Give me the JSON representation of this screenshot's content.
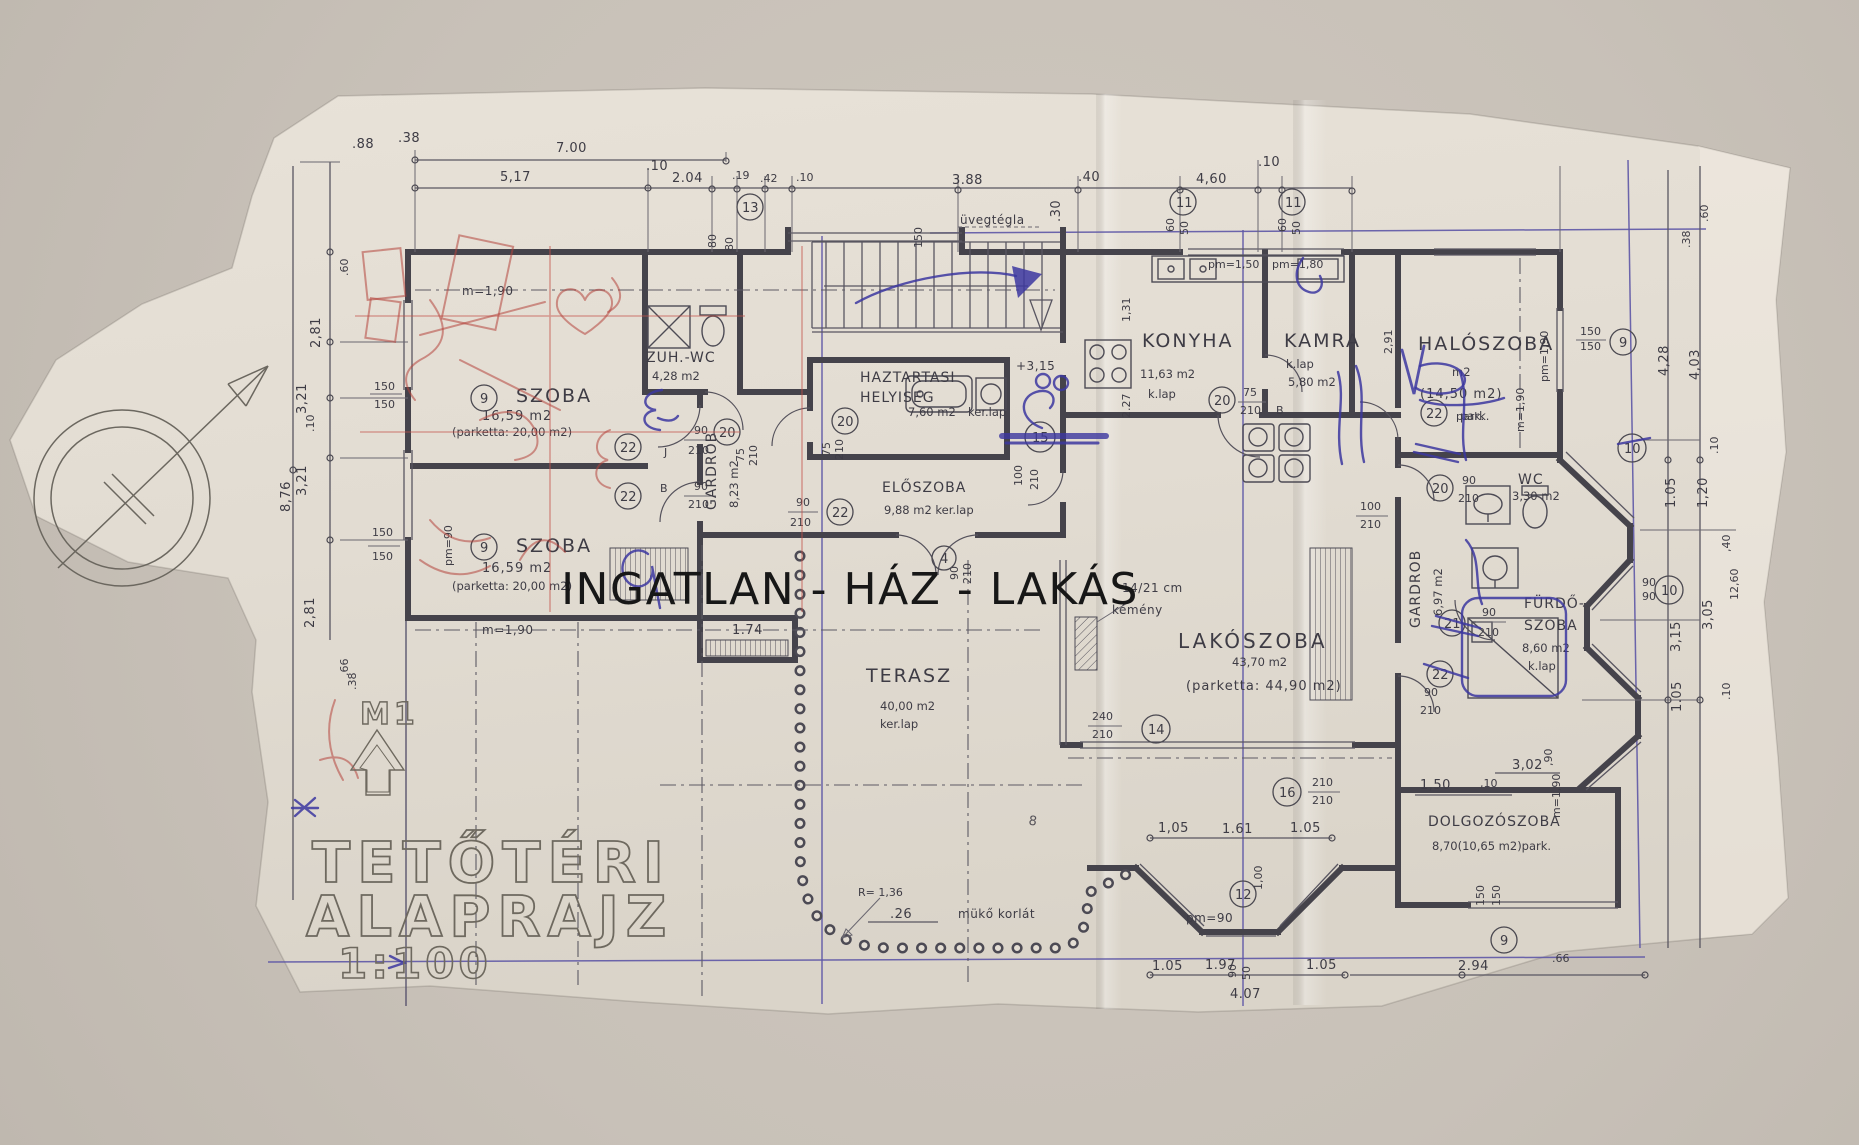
{
  "watermark": "INGATLAN - HÁZ - LAKÁS",
  "title": {
    "line1": "TETŐTÉRI",
    "line2": "ALAPRAJZ",
    "scale": "1:100",
    "section_marker": "M1"
  },
  "rooms": {
    "szoba1": {
      "name": "SZOBA",
      "area": "16,59 m2",
      "floor": "(parketta: 20,00 m2)"
    },
    "szoba2": {
      "name": "SZOBA",
      "area": "16,59 m2",
      "floor": "(parketta: 20,00 m2)"
    },
    "zuh_wc": {
      "name": "ZUH.-WC",
      "area": "4,28 m2"
    },
    "haztartasi": {
      "name_line1": "HAZTARTASI",
      "name_line2": "HELYISEG",
      "area": "7,60 m2",
      "floor": "ker.lap"
    },
    "eloszoba": {
      "name": "ELŐSZOBA",
      "area": "9,88 m2 ker.lap"
    },
    "konyha": {
      "name": "KONYHA",
      "area": "11,63 m2",
      "floor": "k.lap"
    },
    "kamra": {
      "name": "KAMRA",
      "area": "5,80 m2",
      "floor": "k.lap"
    },
    "haloszoba": {
      "name": "HALÓSZOBA",
      "area": "m2",
      "area2": "(14,50 m2)",
      "floor": "park."
    },
    "wc": {
      "name": "WC",
      "area": "3,30 m2"
    },
    "furdoszoba": {
      "name_line1": "FÜRDŐ-",
      "name_line2": "SZOBA",
      "area": "8,60 m2",
      "floor": "k.lap"
    },
    "gardrob1": {
      "name": "GARDROB",
      "area": "8,23 m2"
    },
    "gardrob2": {
      "name": "GARDROB",
      "area": "6,97 m2"
    },
    "lakoszoba": {
      "name": "LAKÓSZOBA",
      "area": "43,70 m2",
      "floor": "(parketta: 44,90 m2)"
    },
    "terasz": {
      "name": "TERASZ",
      "area": "40,00 m2",
      "floor": "ker.lap"
    },
    "dolgozoszoba": {
      "name": "DOLGOZÓSZOBA",
      "area": "8,70(10,65 m2)park."
    }
  },
  "annotations": {
    "uvegtegla": "üvegtégla",
    "level": "+3,15",
    "chimney_size": "14/21 cm",
    "chimney": "kémény",
    "railing": "mükő korlát",
    "radius": "R= 1,36",
    "r26": ".26",
    "pm90": "pm=90",
    "pm150": "pm=1,50",
    "pm180": "pm=1,80",
    "m190": "m=1,90",
    "pm190": "pm=1,90",
    "park": "park."
  },
  "markers": {
    "m4": "4",
    "m8": "8",
    "m9": "9",
    "m10": "10",
    "m11": "11",
    "m12": "12",
    "m13": "13",
    "m14": "14",
    "m15": "15",
    "m16": "16",
    "m20": "20",
    "m21": "21",
    "m22": "22"
  },
  "door_specs": {
    "n50": "50",
    "n60": "60",
    "n75": "75",
    "n80": "80",
    "n90": "90",
    "n100": "100",
    "n150": "150",
    "n210": "210",
    "n240": "240",
    "h100": "1,00",
    "jb": {
      "J": "J",
      "B": "B"
    }
  },
  "dims": {
    "top": [
      ".88",
      ".38",
      "7.00",
      "5,17",
      ".10",
      "2.04",
      ".19",
      ".42",
      ".10",
      "3.88",
      ".40",
      ".30",
      "4,60",
      ".10"
    ],
    "left": [
      ".60",
      "2,81",
      "3,21",
      ".10",
      "3,21",
      "2,81",
      ".66",
      ".38",
      "8,76"
    ],
    "right": [
      ".60",
      ".38",
      "4,28",
      "4,03",
      ".10",
      "1.05",
      "1,20",
      ",40",
      "3,05",
      "3,15",
      "12,60",
      "1.05",
      ".10"
    ],
    "bottom": [
      "1,05",
      "1.61",
      "1.05",
      "1.05",
      "1.97",
      "1.05",
      "4.07",
      "2.94",
      ".66"
    ],
    "inner": [
      "3,02",
      "1,50",
      ",10",
      ",90",
      "1.74",
      "1,31",
      "2.27",
      "2,91",
      "80",
      "80"
    ]
  }
}
